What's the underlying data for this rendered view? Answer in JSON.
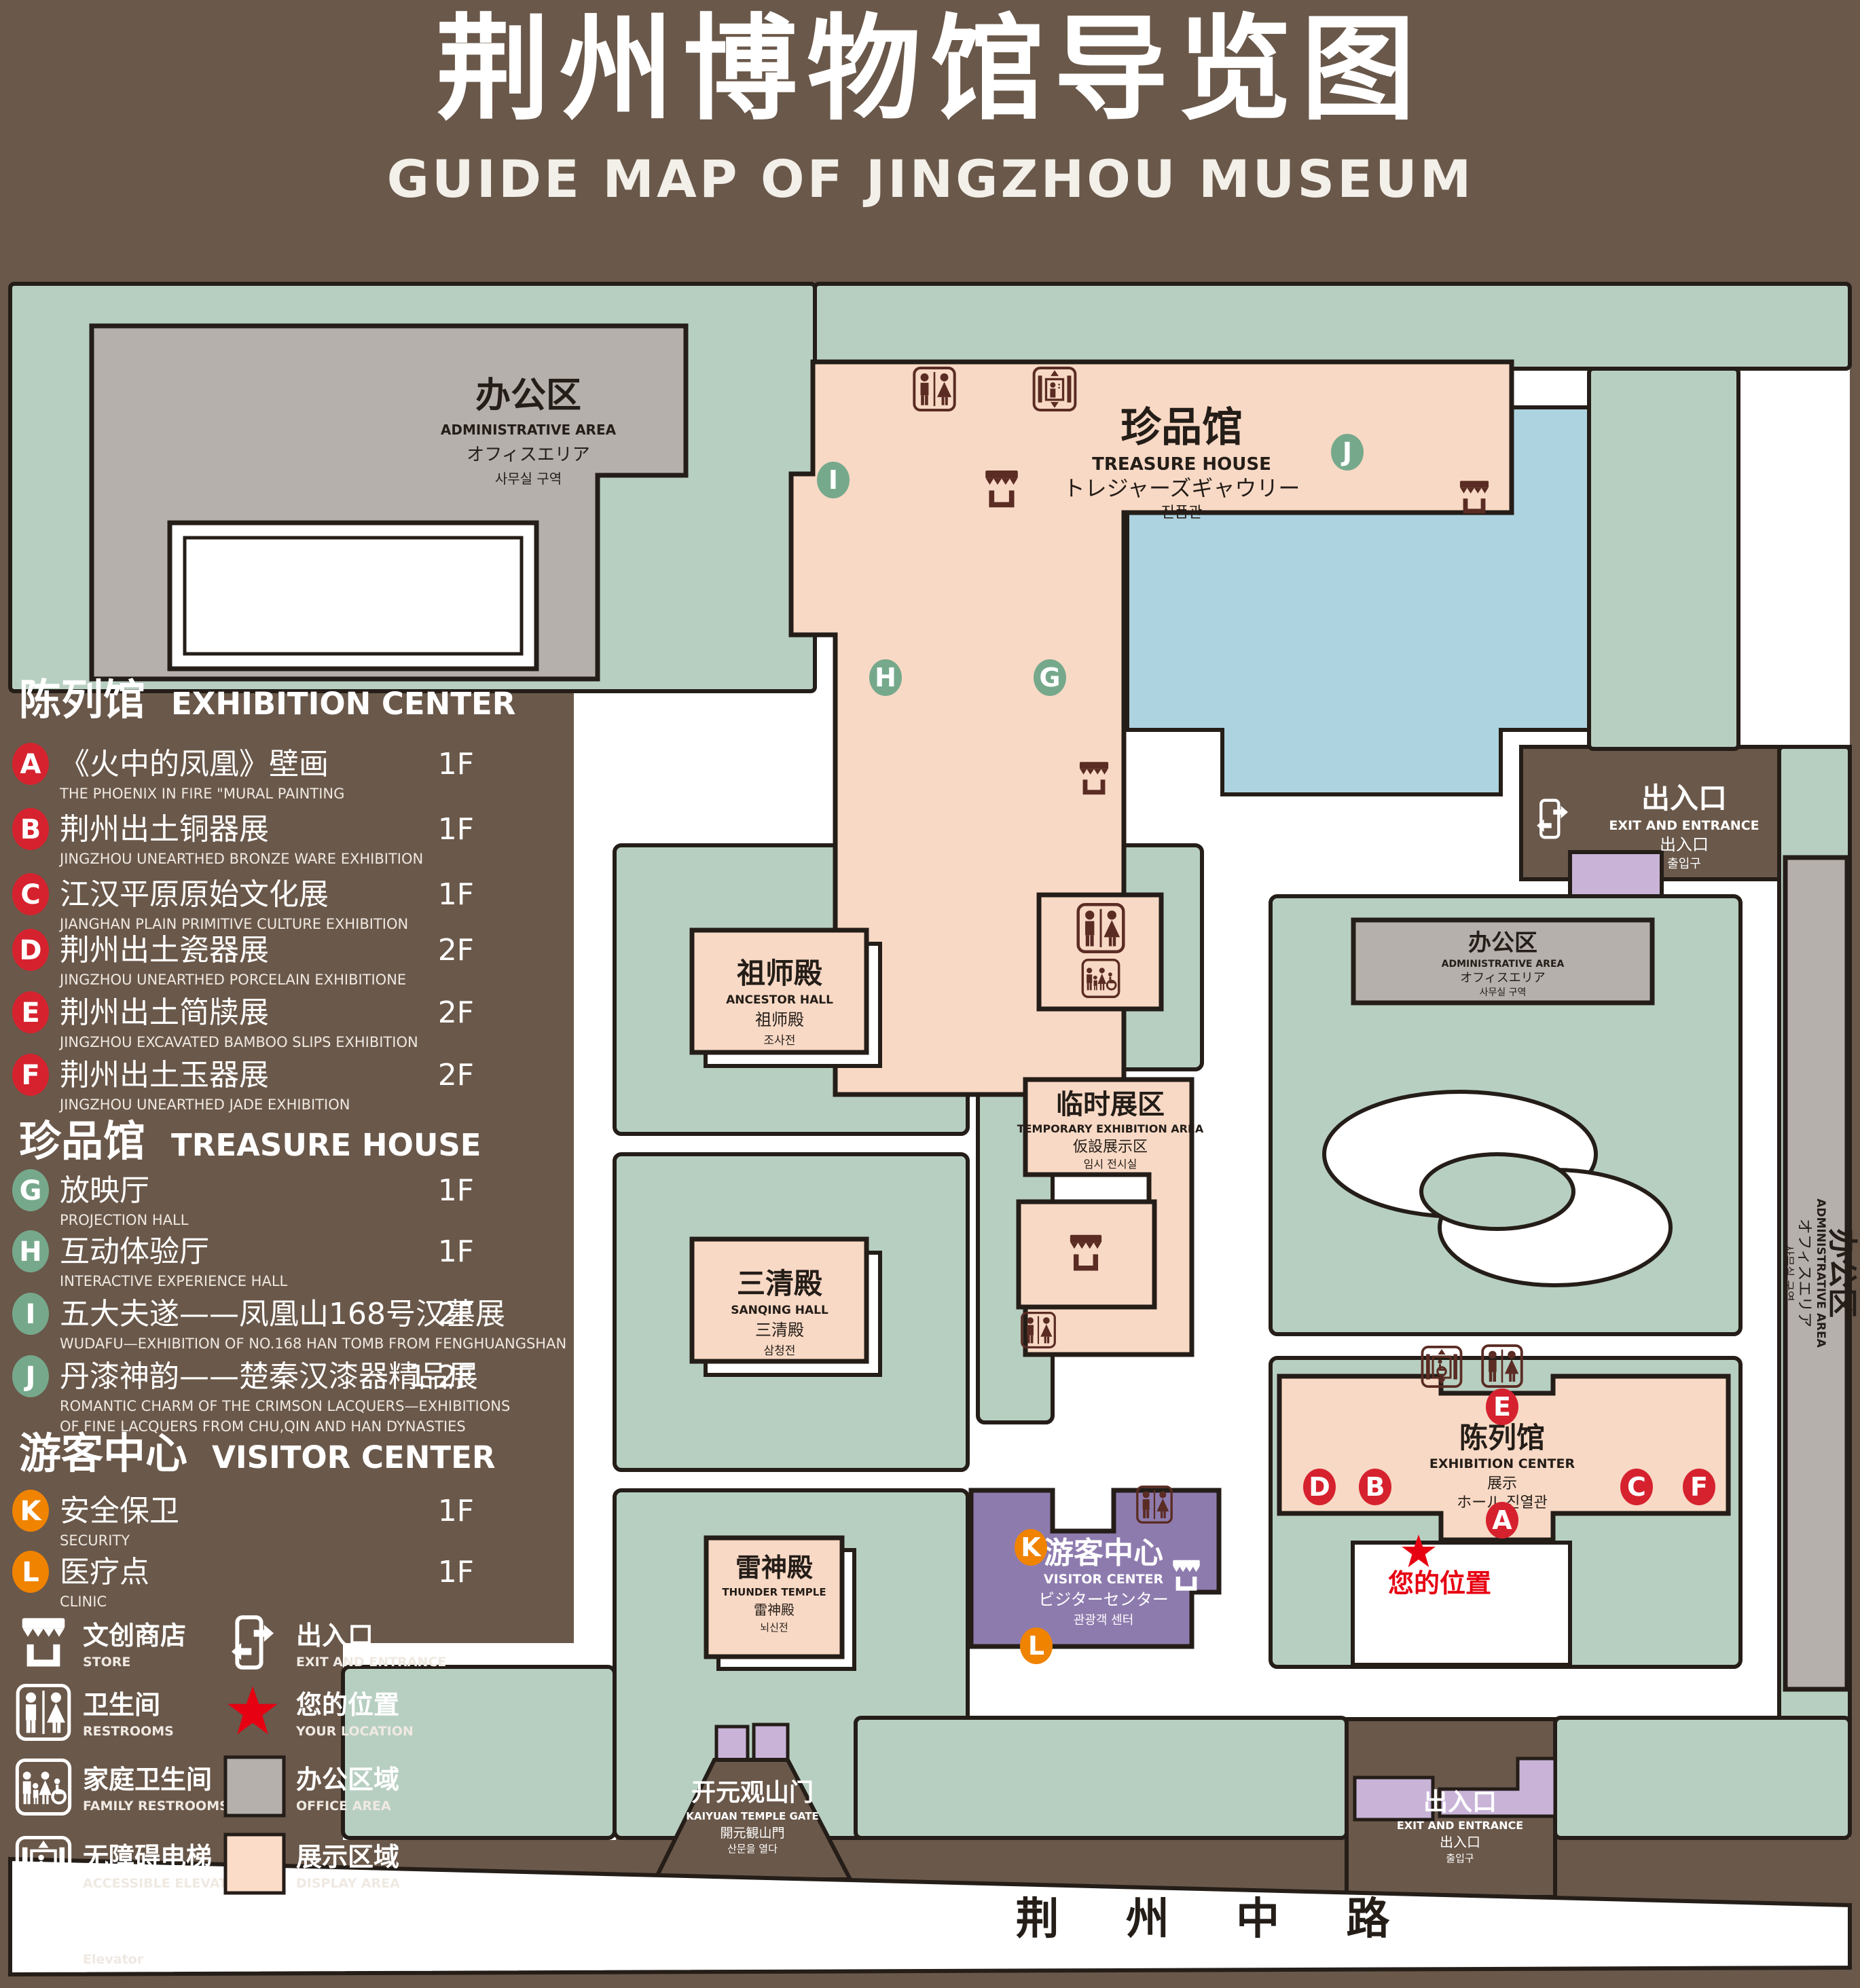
{
  "title": {
    "zh": "荆州博物馆导览图",
    "en": "GUIDE MAP OF JINGZHOU MUSEUM"
  },
  "colors": {
    "background": "#6a584a",
    "map_green": "#b7cfc1",
    "display_area_pink": "#f8d9c5",
    "office_gray": "#b6b0ac",
    "visitor_purple": "#8e7bae",
    "small_purple": "#c9b4d8",
    "water_blue": "#aed3e0",
    "badge_red": "#d6222e",
    "badge_green": "#76a98c",
    "badge_orange": "#f08300",
    "star_red": "#e60012",
    "icon_dark": "#5a2c23",
    "outline": "#241d18"
  },
  "legend": {
    "sections": [
      {
        "zh": "陈列馆",
        "en": "EXHIBITION CENTER",
        "items": [
          {
            "key": "A",
            "zh": "《火中的凤凰》壁画",
            "en": "THE PHOENIX IN FIRE \"MURAL PAINTING",
            "floor": "1F"
          },
          {
            "key": "B",
            "zh": "荆州出土铜器展",
            "en": "JINGZHOU UNEARTHED BRONZE WARE EXHIBITION",
            "floor": "1F"
          },
          {
            "key": "C",
            "zh": "江汉平原原始文化展",
            "en": "JIANGHAN PLAIN PRIMITIVE CULTURE EXHIBITION",
            "floor": "1F"
          },
          {
            "key": "D",
            "zh": "荆州出土瓷器展",
            "en": "JINGZHOU UNEARTHED PORCELAIN EXHIBITIONE",
            "floor": "2F"
          },
          {
            "key": "E",
            "zh": "荆州出土简牍展",
            "en": "JINGZHOU EXCAVATED BAMBOO SLIPS EXHIBITION",
            "floor": "2F"
          },
          {
            "key": "F",
            "zh": "荆州出土玉器展",
            "en": "JINGZHOU UNEARTHED JADE EXHIBITION",
            "floor": "2F"
          }
        ]
      },
      {
        "zh": "珍品馆",
        "en": "TREASURE HOUSE",
        "items": [
          {
            "key": "G",
            "zh": "放映厅",
            "en": "PROJECTION HALL",
            "floor": "1F"
          },
          {
            "key": "H",
            "zh": "互动体验厅",
            "en": "INTERACTIVE EXPERIENCE HALL",
            "floor": "1F"
          },
          {
            "key": "I",
            "zh": "五大夫遂——凤凰山168号汉墓展",
            "en": "WUDAFU—EXHIBITION OF NO.168 HAN TOMB FROM FENGHUANGSHAN",
            "floor": "2F"
          },
          {
            "key": "J",
            "zh": "丹漆神韵——楚秦汉漆器精品展",
            "en": "ROMANTIC CHARM OF THE CRIMSON LACQUERS—EXHIBITIONS",
            "en2": "OF FINE LACQUERS FROM CHU,QIN AND HAN DYNASTIES",
            "floor": "1-2F"
          }
        ]
      },
      {
        "zh": "游客中心",
        "en": "VISITOR CENTER",
        "items": [
          {
            "key": "K",
            "zh": "安全保卫",
            "en": "SECURITY",
            "floor": "1F"
          },
          {
            "key": "L",
            "zh": "医疗点",
            "en": "CLINIC",
            "floor": "1F"
          }
        ]
      }
    ],
    "symbols": [
      {
        "icon": "store-icon",
        "zh": "文创商店",
        "en": "STORE"
      },
      {
        "icon": "exit-icon",
        "zh": "出入口",
        "en": "EXIT AND ENTRANCE"
      },
      {
        "icon": "restroom-icon",
        "zh": "卫生间",
        "en": "RESTROOMS"
      },
      {
        "icon": "location-star-icon",
        "zh": "您的位置",
        "en": "YOUR LOCATION"
      },
      {
        "icon": "family-restroom-icon",
        "zh": "家庭卫生间",
        "en": "FAMILY RESTROOMS"
      },
      {
        "icon": "office-area-swatch",
        "zh": "办公区域",
        "en": "OFFICE AREA"
      },
      {
        "icon": "accessible-elevator-icon",
        "zh": "无障碍电梯",
        "en": "ACCESSIBLE ELEVATOR"
      },
      {
        "icon": "display-area-swatch",
        "zh": "展示区域",
        "en": "DISPLAY AREA"
      },
      {
        "icon": "elevator-icon",
        "zh": "电梯",
        "en": "Elevator"
      }
    ]
  },
  "map": {
    "buildings": {
      "admin_nw": {
        "zh": "办公区",
        "en": "ADMINISTRATIVE AREA",
        "ja": "オフィスエリア",
        "ko": "사무실 구역"
      },
      "treasure": {
        "zh": "珍品馆",
        "en": "TREASURE HOUSE",
        "ja": "トレジャーズギャウリー",
        "ko": "진품관"
      },
      "ancestor": {
        "zh": "祖师殿",
        "en": "ANCESTOR HALL",
        "ja": "祖师殿",
        "ko": "조사전"
      },
      "temp": {
        "zh": "临时展区",
        "en": "TEMPORARY EXHIBITION AREA",
        "ja": "仮設展示区",
        "ko": "임시 전시실"
      },
      "sanqing": {
        "zh": "三清殿",
        "en": "SANQING HALL",
        "ja": "三清殿",
        "ko": "삼청전"
      },
      "thunder": {
        "zh": "雷神殿",
        "en": "THUNDER TEMPLE",
        "ja": "雷神殿",
        "ko": "뇌신전"
      },
      "visitor": {
        "zh": "游客中心",
        "en": "VISITOR CENTER",
        "ja": "ビジターセンター",
        "ko": "관광객 센터"
      },
      "admin_center_right": {
        "zh": "办公区",
        "en": "ADMINISTRATIVE AREA",
        "ja": "オフィスエリア",
        "ko": "사무실 구역"
      },
      "admin_far_right": {
        "zh": "办公区",
        "en": "ADMINISTRATIVE AREA",
        "ja": "オフィスエリア",
        "ko": "사무실 구역"
      },
      "exhibition": {
        "zh": "陈列馆",
        "en": "EXHIBITION CENTER",
        "l3": "展示",
        "l4": "ホール 진열관"
      }
    },
    "gates": {
      "kaiyuan": {
        "zh": "开元观山门",
        "en": "KAIYUAN TEMPLE GATE",
        "ja": "開元観山門",
        "ko": "산문을 열다"
      },
      "exit_east": {
        "zh": "出入口",
        "en": "EXIT AND ENTRANCE",
        "ja": "出入口",
        "ko": "출입구"
      },
      "exit_south": {
        "zh": "出入口",
        "en": "EXIT AND ENTRANCE",
        "ja": "出入口",
        "ko": "출입구"
      }
    },
    "road": {
      "name": "荆 州 中 路"
    },
    "your_location": {
      "zh": "您的位置"
    }
  }
}
